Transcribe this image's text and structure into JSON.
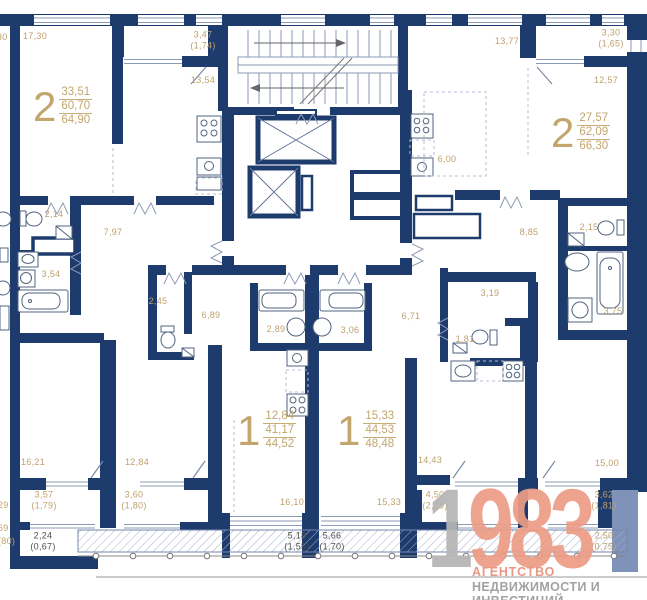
{
  "colors": {
    "wall": "#1e3b6d",
    "light_wall": "#7e92ba",
    "dimension_text": "#bfa06d",
    "balcony_text_dark": "#4f4f4f",
    "logo_accent": "#ec9d86",
    "logo_gray": "#b5b5b5"
  },
  "apartments": [
    {
      "type": "2",
      "areas": [
        "33,51",
        "60,70",
        "64,90"
      ]
    },
    {
      "type": "2",
      "areas": [
        "27,57",
        "62,09",
        "66,30"
      ]
    },
    {
      "type": "1",
      "areas": [
        "12,84",
        "41,17",
        "44,52"
      ]
    },
    {
      "type": "1",
      "areas": [
        "15,33",
        "44,53",
        "48,48"
      ]
    }
  ],
  "dims": [
    {
      "text": "17,30"
    },
    {
      "text": "30"
    },
    {
      "text": "3,47\n(1,74)"
    },
    {
      "text": "13,54"
    },
    {
      "text": "13,77"
    },
    {
      "text": "3,30\n(1,65)"
    },
    {
      "text": "12,57"
    },
    {
      "text": "6,00"
    },
    {
      "text": "2,14"
    },
    {
      "text": "7,97"
    },
    {
      "text": "3,54"
    },
    {
      "text": "2,45"
    },
    {
      "text": "6,89"
    },
    {
      "text": "2,89"
    },
    {
      "text": "3,06"
    },
    {
      "text": "8,85"
    },
    {
      "text": "2,15"
    },
    {
      "text": "3,19"
    },
    {
      "text": "6,71"
    },
    {
      "text": "1,81"
    },
    {
      "text": "3,75"
    },
    {
      "text": "16,21"
    },
    {
      "text": "12,84"
    },
    {
      "text": "16,10"
    },
    {
      "text": "15,33"
    },
    {
      "text": "14,43"
    },
    {
      "text": "15,00"
    },
    {
      "text": "3,57\n(1,79)"
    },
    {
      "text": "3,60\n(1,80)"
    },
    {
      "text": "4,50\n(2,25)"
    },
    {
      "text": "3,62\n(1,81)"
    },
    {
      "text": "2,50\n(0,75)"
    },
    {
      "text": "2,24\n(0,67)"
    },
    {
      "text": "5,18\n(1,55)"
    },
    {
      "text": "5,66\n(1,70)"
    },
    {
      "text": "29"
    },
    {
      "text": "69"
    },
    {
      "text": "(80)"
    }
  ],
  "logo": {
    "year_prefix": "1",
    "year_suffix": "983",
    "line1": "АГЕНТСТВО",
    "line2": "НЕДВИЖИМОСТИ И ИНВЕСТИЦИЙ"
  }
}
